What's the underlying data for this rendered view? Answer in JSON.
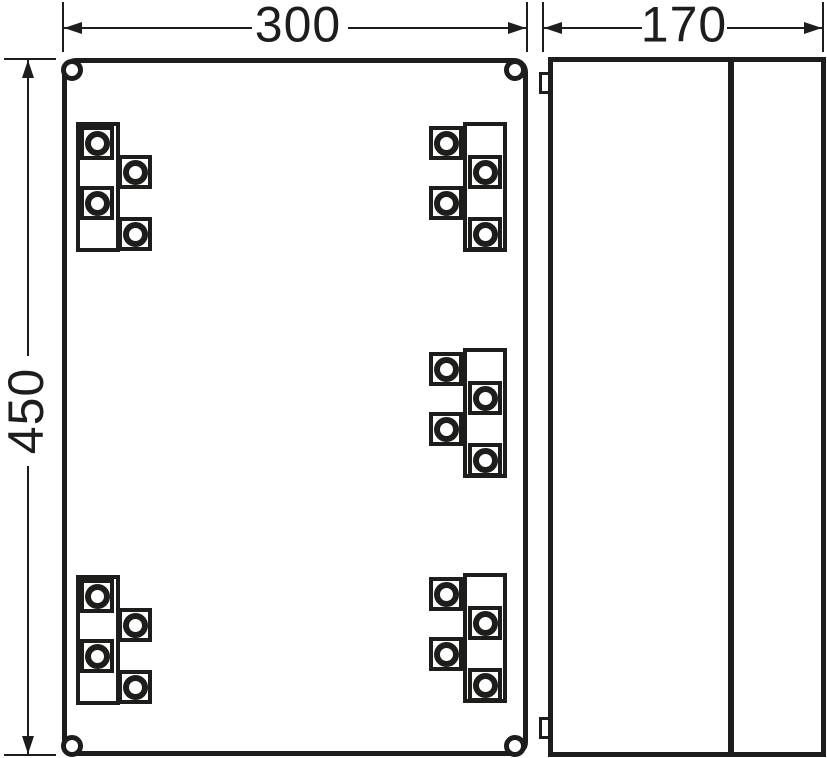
{
  "drawing": {
    "type": "enclosure-dimension-drawing",
    "line_color": "#1d1d1b",
    "background_color": "#ffffff"
  },
  "dimensions": {
    "front_width": "300",
    "front_height": "450",
    "side_depth": "170"
  },
  "front_view": {
    "corner_hole_centers": [
      [
        72,
        70
      ],
      [
        515,
        70
      ],
      [
        72,
        746
      ],
      [
        515,
        746
      ]
    ],
    "terminal_groups": [
      {
        "id": "top-left",
        "x": 76,
        "y": 122,
        "variant": "left"
      },
      {
        "id": "top-right",
        "x": 429,
        "y": 122,
        "variant": "right"
      },
      {
        "id": "middle-right",
        "x": 429,
        "y": 348,
        "variant": "right"
      },
      {
        "id": "bottom-left",
        "x": 76,
        "y": 575,
        "variant": "left"
      },
      {
        "id": "bottom-right",
        "x": 429,
        "y": 573,
        "variant": "right"
      }
    ]
  },
  "side_view": {
    "hinge_tabs": [
      {
        "id": "top",
        "x": 539,
        "y": 72
      },
      {
        "id": "bottom",
        "x": 539,
        "y": 717
      }
    ]
  }
}
